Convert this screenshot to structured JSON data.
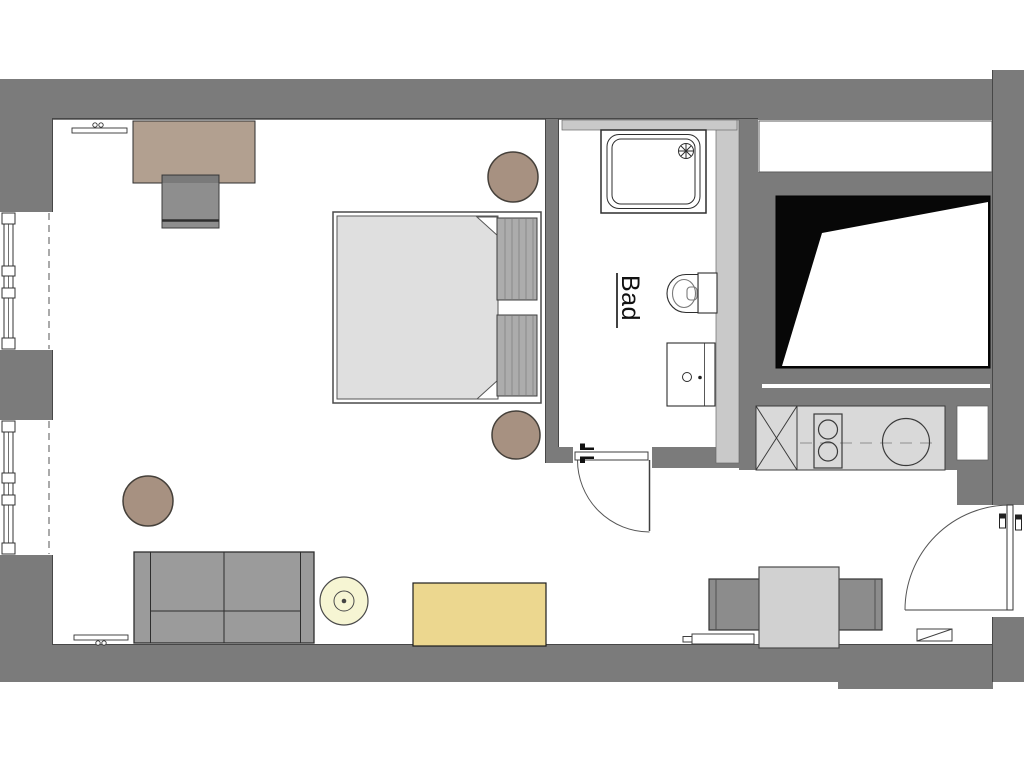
{
  "document": {
    "type": "architectural-floor-plan",
    "description_visible_text_only": true
  },
  "labels": {
    "bathroom": "Bad"
  },
  "palette": {
    "background": "#ffffff",
    "wall": "#7b7b7b",
    "wall_light": "#c9c9c9",
    "counter": "#d9d9d9",
    "mattress": "#dfdfdf",
    "pillow": "#acacac",
    "wood": "#b2a090",
    "desk_chair": "#8e8e8e",
    "sofa": "#9b9b9b",
    "dining_table": "#d1d1d1",
    "dining_chair": "#8c8c8c",
    "stool": "#a79181",
    "yellow": "#ecd78f",
    "yellow_light": "#f6f5d3",
    "void_black": "#070707",
    "fixture_line": "#2e2e2e",
    "edge_line": "#474747",
    "label": "#111111"
  },
  "symbols": [
    "exterior-walls",
    "window",
    "window",
    "double-bed-with-pillows",
    "desk",
    "desk-chair",
    "wall-shelf",
    "wall-shelf",
    "stool",
    "stool",
    "stool",
    "sofa",
    "round-side-table",
    "sideboard",
    "dining-table",
    "dining-chair",
    "dining-chair",
    "shower",
    "toilet",
    "bathroom-sink",
    "kitchen-counter",
    "cooktop",
    "kitchen-sink",
    "tall-cabinet-x",
    "interior-door-swing",
    "entrance-door-swing",
    "radiator",
    "doormat",
    "void-shaft"
  ]
}
